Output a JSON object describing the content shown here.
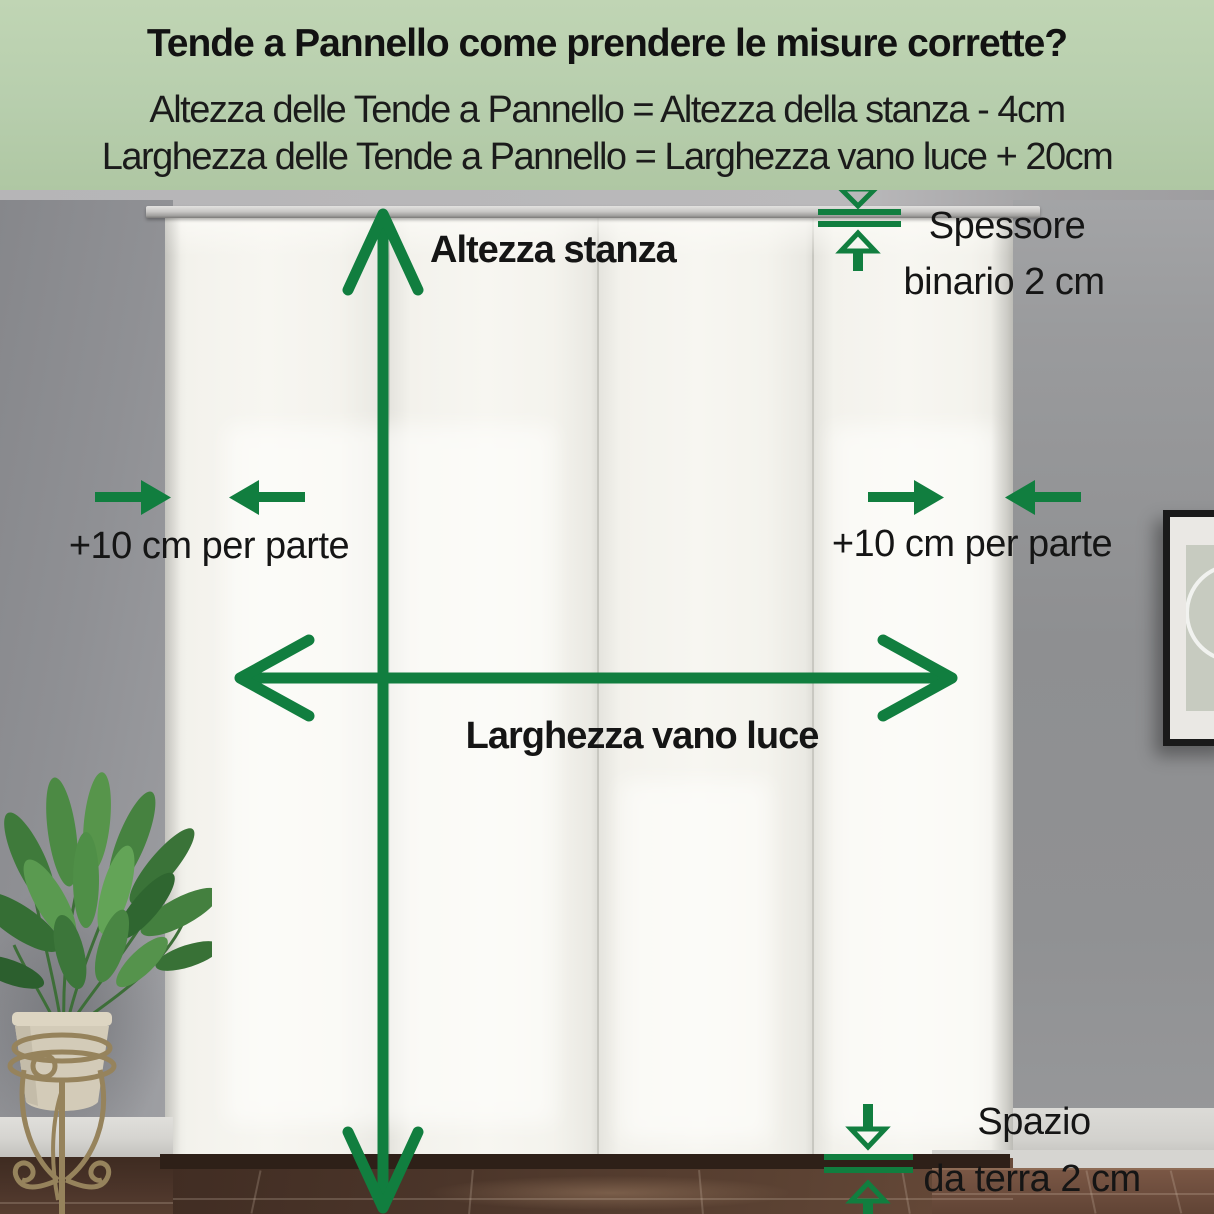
{
  "meta": {
    "type": "measurement-infographic",
    "language": "it"
  },
  "header": {
    "title": "Tende a Pannello come prendere le misure corrette?",
    "formula_height": "Altezza delle Tende a Pannello = Altezza della stanza - 4cm",
    "formula_width": "Larghezza delle Tende a Pannello = Larghezza vano luce + 20cm"
  },
  "labels": {
    "room_height": "Altezza stanza",
    "opening_width": "Larghezza vano luce",
    "left_margin": "+10 cm per parte",
    "right_margin": "+10 cm per parte",
    "rail_thickness_line1": "Spessore",
    "rail_thickness_line2": "binario 2 cm",
    "floor_gap_line1": "Spazio",
    "floor_gap_line2": "da terra 2 cm"
  },
  "colors": {
    "accent_green": "#117e3f",
    "text": "#151515",
    "header_bg": "#b7cead",
    "curtain": "#f2f1eb",
    "wall_gray": "#8f9093"
  }
}
